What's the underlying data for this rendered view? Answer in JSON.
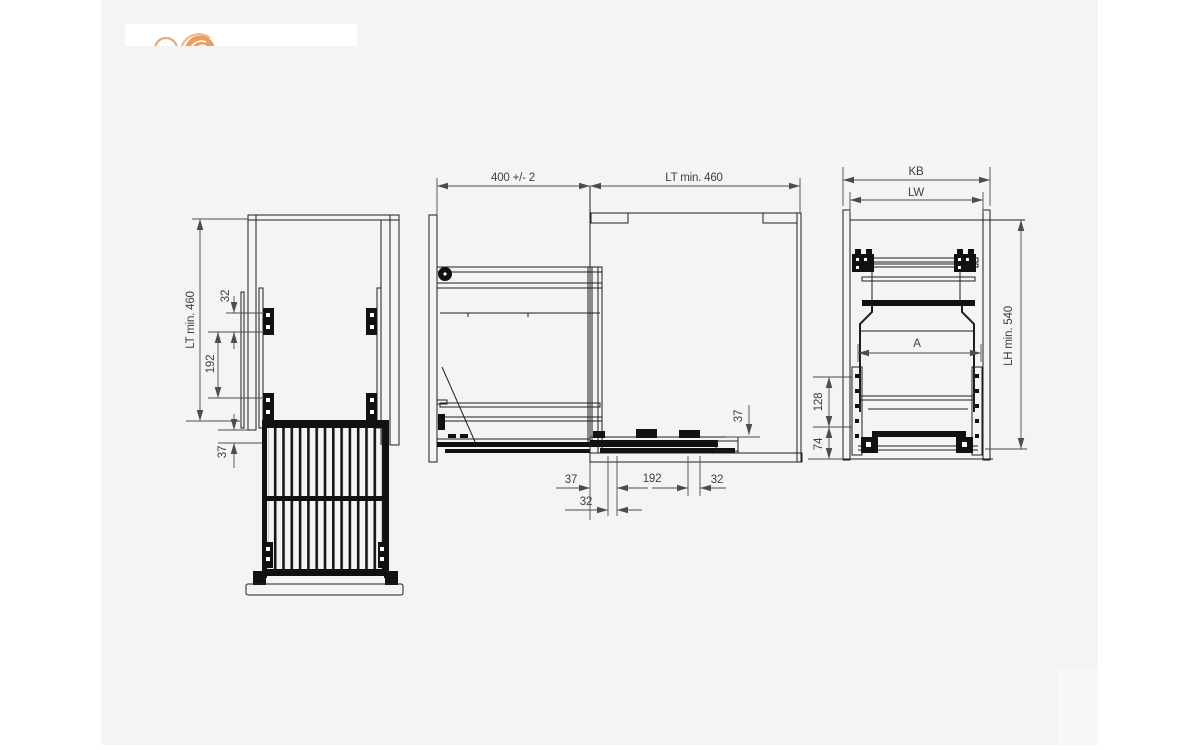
{
  "page": {
    "background": "#ffffff",
    "panel_background": "#f4f4f4",
    "drawing_line_color": "#1e1e1e",
    "dimension_color": "#4d4d4d",
    "logo_accent_color": "#e9995c"
  },
  "plan_view": {
    "dim_depth": "LT min. 460",
    "dim_32": "32",
    "dim_192": "192",
    "dim_37": "37"
  },
  "side_view": {
    "dim_door_depth": "400 +/- 2",
    "dim_cabinet_depth": "LT min. 460",
    "dim_37_bottom": "37",
    "dim_192_bottom": "192",
    "dim_32_bottom": "32",
    "dim_32_offset": "32",
    "dim_37_height": "37"
  },
  "front_view": {
    "dim_outer_width": "KB",
    "dim_inner_width": "LW",
    "dim_height": "LH min. 540",
    "dim_basket_width": "A",
    "dim_128": "128",
    "dim_74": "74"
  }
}
